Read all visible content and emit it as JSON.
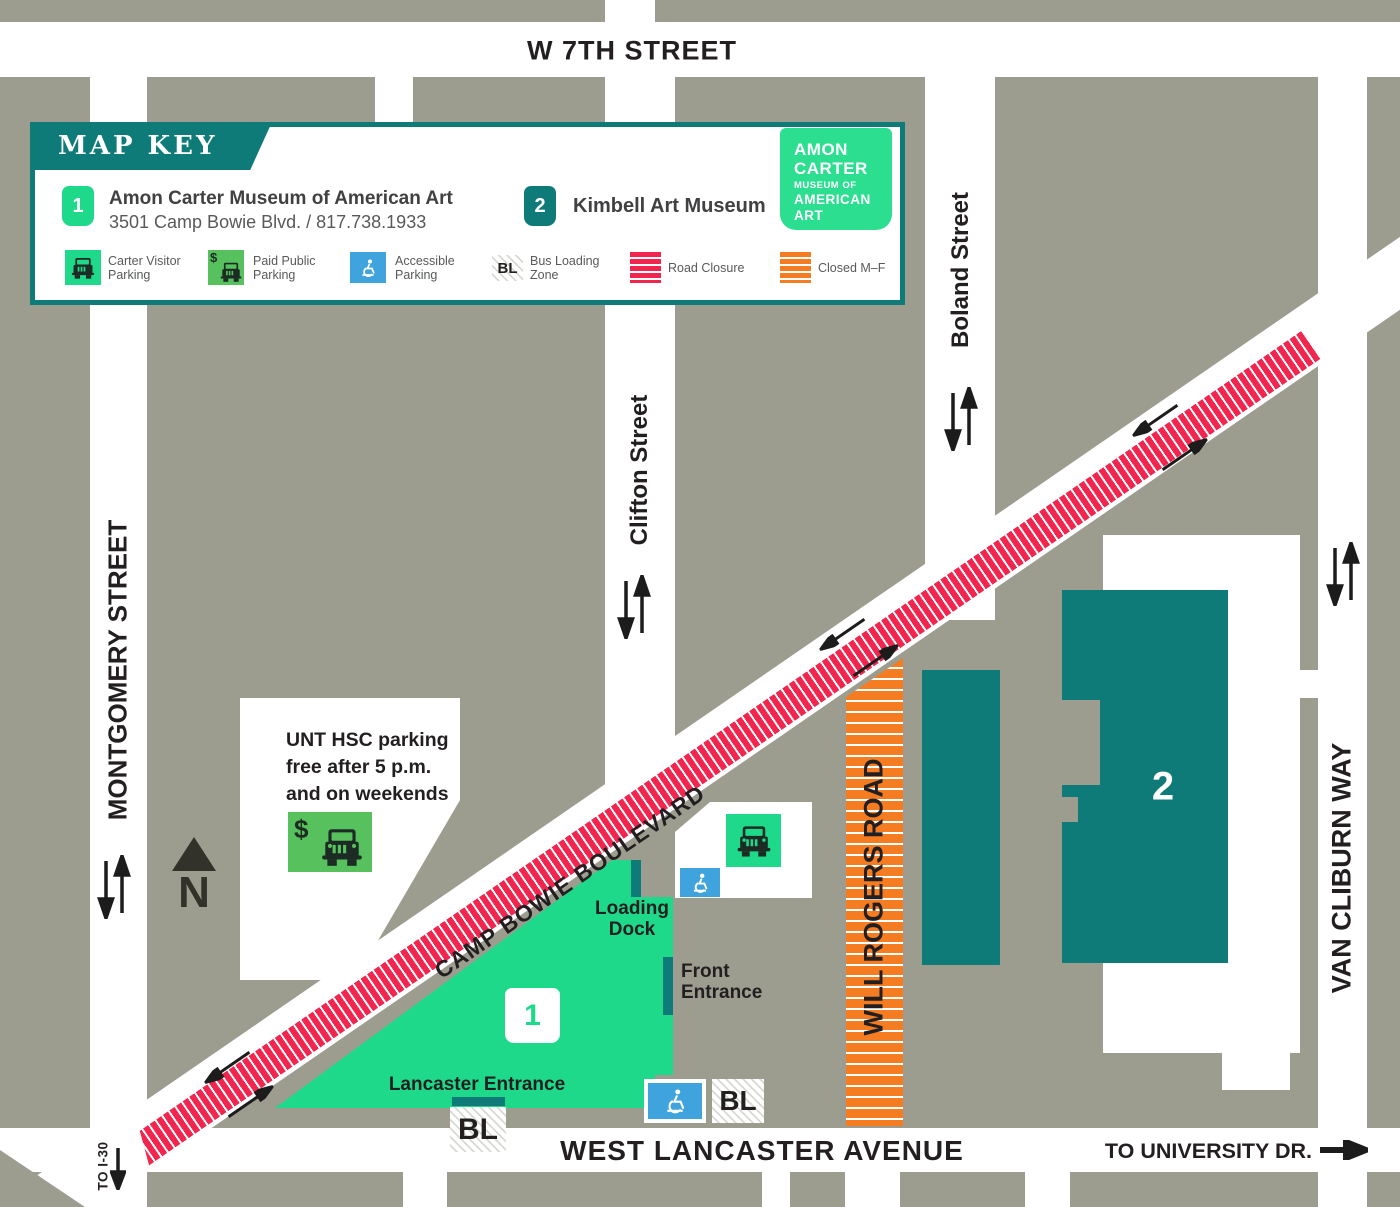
{
  "colors": {
    "map_gray": "#9C9C8F",
    "teal": "#0F7B79",
    "green": "#1FD98B",
    "paid_green": "#57C15D",
    "accessible_blue": "#3FA3DD",
    "closure_red": "#F2254E",
    "closed_orange": "#F57C20",
    "ink": "#231F20",
    "text_gray": "#58595B"
  },
  "streets": {
    "w7th": "W 7TH STREET",
    "montgomery": "MONTGOMERY STREET",
    "clifton": "Clifton Street",
    "boland": "Boland Street",
    "van_cliburn": "VAN CLIBURN WAY",
    "will_rogers": "WILL ROGERS ROAD",
    "camp_bowie": "CAMP BOWIE BOULEVARD",
    "lancaster": "WEST LANCASTER AVENUE",
    "to_i30": "TO I-30",
    "to_university": "TO UNIVERSITY DR."
  },
  "map_key": {
    "title": "MAP KEY",
    "items": [
      {
        "num": "1",
        "title": "Amon Carter Museum of American Art",
        "subtitle": "3501 Camp Bowie Blvd. / 817.738.1933"
      },
      {
        "num": "2",
        "title": "Kimbell Art Museum",
        "subtitle": ""
      }
    ],
    "legend": [
      {
        "name": "carter-visitor-parking",
        "line1": "Carter Visitor",
        "line2": "Parking"
      },
      {
        "name": "paid-public-parking",
        "line1": "Paid Public",
        "line2": "Parking"
      },
      {
        "name": "accessible-parking",
        "line1": "Accessible",
        "line2": "Parking"
      },
      {
        "name": "bus-loading-zone",
        "badge": "BL",
        "line1": "Bus Loading",
        "line2": "Zone"
      },
      {
        "name": "road-closure",
        "line1": "Road Closure",
        "line2": ""
      },
      {
        "name": "closed-mf",
        "line1": "Closed M–F",
        "line2": ""
      }
    ]
  },
  "logo": {
    "line1": "AMON",
    "line2": "CARTER",
    "line3": "MUSEUM OF",
    "line4": "AMERICAN",
    "line5": "ART"
  },
  "labels": {
    "unt1": "UNT HSC parking",
    "unt2": "free after 5 p.m.",
    "unt3": "and on weekends",
    "loading1": "Loading",
    "loading2": "Dock",
    "front1": "Front",
    "front2": "Entrance",
    "lancaster_entrance": "Lancaster Entrance",
    "bl": "BL",
    "north": "N",
    "building1": "1",
    "building2": "2"
  }
}
